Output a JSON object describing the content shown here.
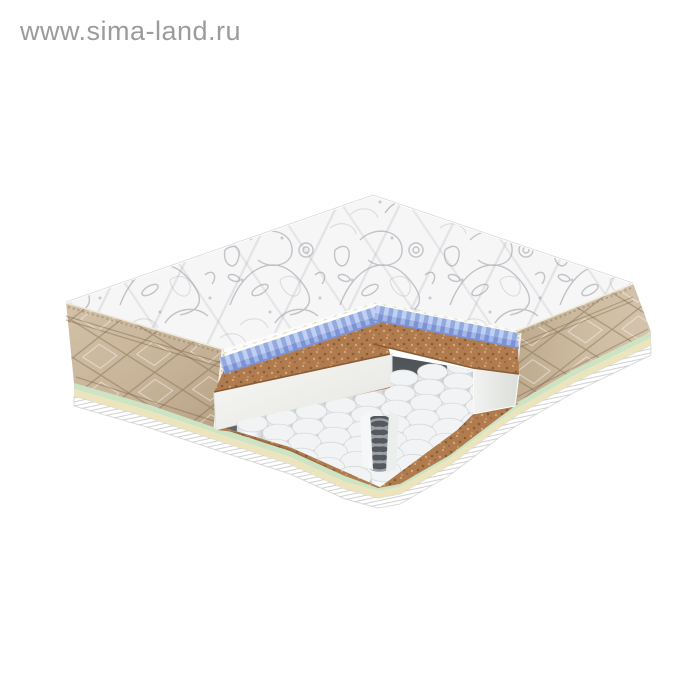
{
  "watermark": {
    "text": "www.sima-land.ru",
    "color": "#9b9b9b"
  },
  "scene": {
    "subject": "mattress-cutaway-product-photo",
    "layers_top_to_bottom": [
      "quilted-floral-cover",
      "wave-profile-foam",
      "coconut-coir-sheet",
      "pocket-spring-block",
      "coconut-coir-base",
      "foam-base-layers",
      "quilted-bottom-border"
    ]
  },
  "colors": {
    "fabric": "#f6f6f7",
    "fabric_pattern": "#b5b5bb",
    "panel": "#c8b59a",
    "panel_dark": "#b4a084",
    "panel_line": "#a08866",
    "blue_light": "#c1cff2",
    "blue": "#9db4e6",
    "blue_dark": "#7c93d3",
    "backing": "#dde3b0",
    "coir": "#b07c4f",
    "coir_dark": "#8a5c36",
    "coir_light": "#d8a872",
    "wall_white": "#f5f5f3",
    "pit": "#5a5f63",
    "spring_white": "#f2f3f4",
    "spring_shade": "#c0c4c7",
    "coil": "#9aa0a5",
    "cream": "#ece4bd",
    "green": "#cde4c4",
    "fringe": "#ffffff"
  },
  "springs": {
    "rows_back_to_front": 7,
    "cols": 8
  }
}
